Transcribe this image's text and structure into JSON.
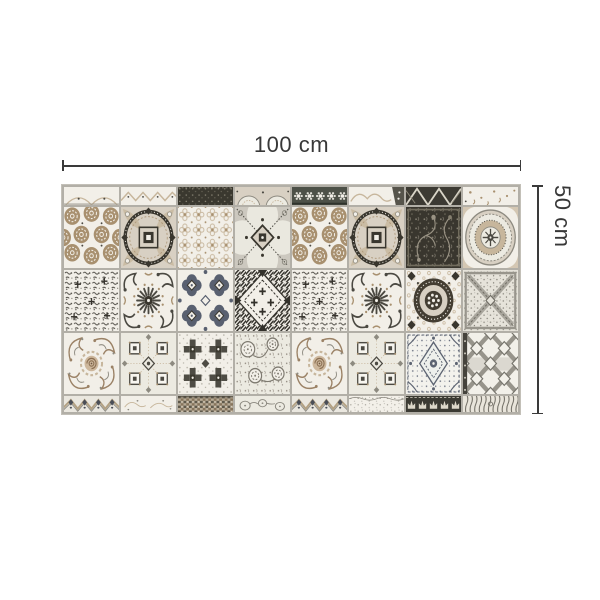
{
  "diagram": {
    "width_label": "100 cm",
    "height_label": "50 cm"
  },
  "mat": {
    "columns": 8,
    "full_rows": 3,
    "top_strip": [
      "edge-arcs",
      "edge-chevron",
      "edge-dark-speckle",
      "edge-plate",
      "edge-flower-band",
      "edge-scrolls",
      "edge-dark-lattice",
      "edge-marks"
    ],
    "rows": [
      [
        "rosette-dots",
        "curved-frame",
        "lace-floral",
        "compass-circle",
        "rosette-dots",
        "curved-frame",
        "dark-damask",
        "medallion-plate"
      ],
      [
        "speckle-lace",
        "sunburst",
        "quatrefoil-grid",
        "diagonal-geo",
        "speckle-lace",
        "sunburst",
        "ring-medallion",
        "cross-hatch-x"
      ],
      [
        "rococo-scroll",
        "diamond-grid",
        "dark-cross",
        "floral-speckle",
        "rococo-scroll",
        "diamond-grid",
        "lace-diamond",
        "trellis"
      ]
    ],
    "bottom_strip": [
      "border-chevron-fleur",
      "border-floral-sketch",
      "border-mosaic",
      "border-toile",
      "border-chevron-fleur",
      "border-speckle",
      "border-crowns",
      "border-woodgrain"
    ]
  },
  "colors": {
    "background": "#ffffff",
    "dimension": "#3a3a3a",
    "grout": "#b2afa7",
    "cream": "#f2efe8",
    "ivory": "#eceae1",
    "taupe": "#d8d0c3",
    "tan": "#a8906f",
    "lighttan": "#c7b69c",
    "charcoal": "#39362e",
    "darkgray": "#4b4942",
    "slate": "#596070",
    "midgray": "#8d8a80",
    "lightgray": "#ccc8bf",
    "darkolive": "#4d5148"
  }
}
